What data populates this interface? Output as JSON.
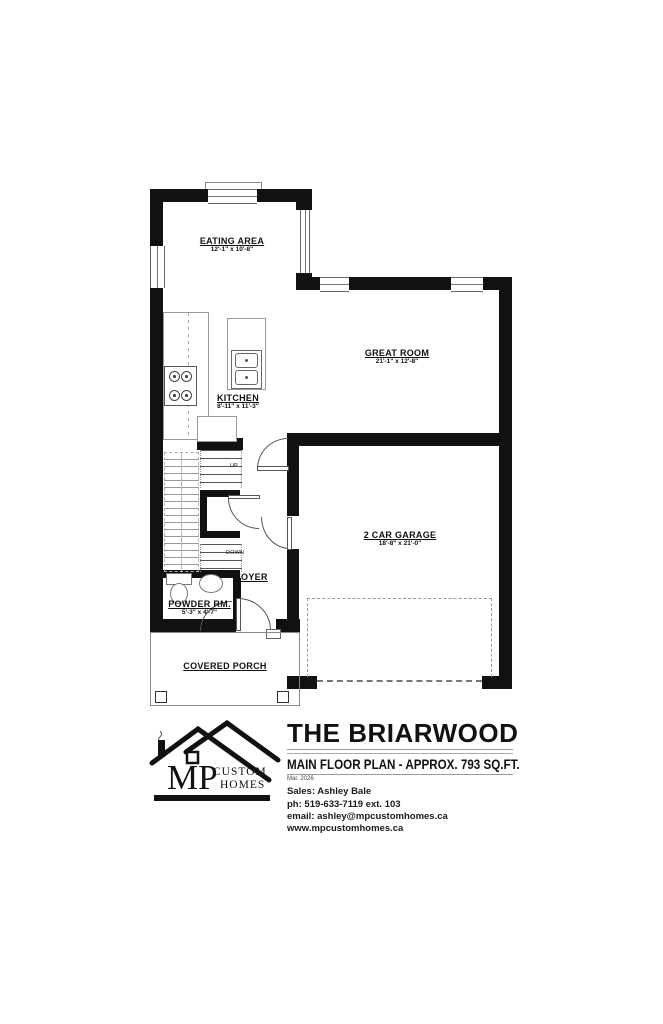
{
  "brand": {
    "mark": "MP",
    "word1": "CUSTOM",
    "word2": "HOMES"
  },
  "title_block": {
    "title": "THE BRIARWOOD",
    "subtitle": "MAIN FLOOR PLAN - APPROX. 793 SQ.FT.",
    "date": "Mar. 2026",
    "sales": "Sales: Ashley Bale",
    "phone": "ph: 519-633-7119 ext. 103",
    "email": "email: ashley@mpcustomhomes.ca",
    "website": "www.mpcustomhomes.ca"
  },
  "plan": {
    "rooms": {
      "eating": {
        "name": "EATING AREA",
        "dims": "12'-1\" x 10'-8\""
      },
      "great": {
        "name": "GREAT ROOM",
        "dims": "21'-1\" x 12'-8\""
      },
      "kitchen": {
        "name": "KITCHEN",
        "dims": "8'-11\" x 11'-3\""
      },
      "garage": {
        "name": "2 CAR GARAGE",
        "dims": "18'-8\" x 21'-0\""
      },
      "foyer": {
        "name": "FOYER"
      },
      "powder": {
        "name": "POWDER RM.",
        "dims": "5'-3\" x 4'-7\""
      },
      "porch": {
        "name": "COVERED PORCH"
      }
    },
    "stairs": {
      "up": "UP",
      "down": "DOWN"
    }
  },
  "colors": {
    "wall": "#111111",
    "thin_line": "#888888",
    "text": "#111111"
  }
}
